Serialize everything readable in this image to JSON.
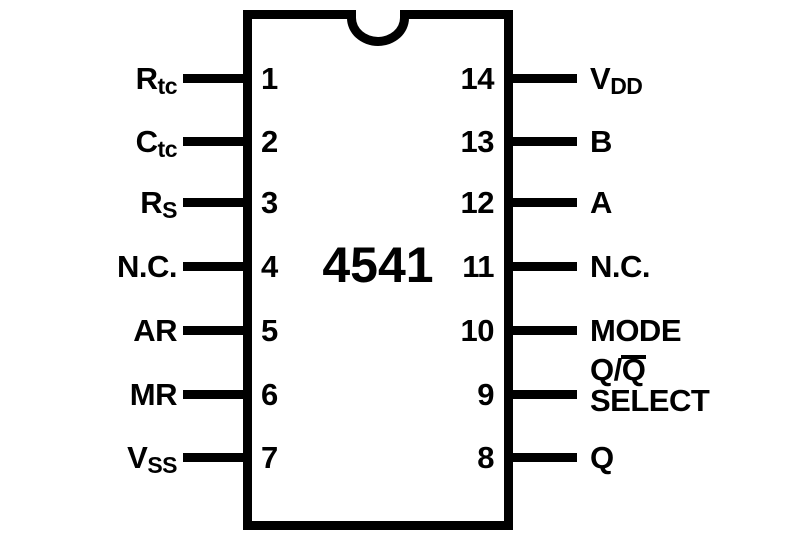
{
  "chip": {
    "part_number": "4541",
    "package": "14-pin DIP pinout diagram"
  },
  "colors": {
    "ink": "#000000",
    "background": "#ffffff"
  },
  "pins_left": [
    {
      "number": "1",
      "label_main": "R",
      "label_sub": "tc"
    },
    {
      "number": "2",
      "label_main": "C",
      "label_sub": "tc"
    },
    {
      "number": "3",
      "label_main": "R",
      "label_sub": "S"
    },
    {
      "number": "4",
      "label_main": "N.C.",
      "label_sub": ""
    },
    {
      "number": "5",
      "label_main": "AR",
      "label_sub": ""
    },
    {
      "number": "6",
      "label_main": "MR",
      "label_sub": ""
    },
    {
      "number": "7",
      "label_main": "V",
      "label_sub": "SS"
    }
  ],
  "pins_right": [
    {
      "number": "14",
      "label_main": "V",
      "label_sub": "DD"
    },
    {
      "number": "13",
      "label_main": "B",
      "label_sub": ""
    },
    {
      "number": "12",
      "label_main": "A",
      "label_sub": ""
    },
    {
      "number": "11",
      "label_main": "N.C.",
      "label_sub": ""
    },
    {
      "number": "10",
      "label_main": "MODE",
      "label_sub": ""
    },
    {
      "number": "9",
      "label_line1_pre": "Q/",
      "label_line1_over": "Q",
      "label_line2": "SELECT"
    },
    {
      "number": "8",
      "label_main": "Q",
      "label_sub": ""
    }
  ]
}
